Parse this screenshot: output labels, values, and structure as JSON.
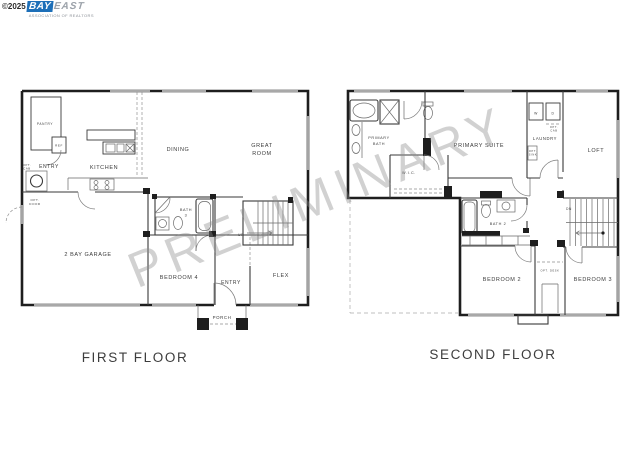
{
  "logo": {
    "copyright": "©2025",
    "brand_primary": "BAY",
    "brand_secondary": "EAST",
    "tagline": "ASSOCIATION OF REALTORS",
    "brand_color": "#1d6fb8",
    "secondary_color": "#9ba1a9"
  },
  "watermark": {
    "text": "PRELIMINARY",
    "color": "#8c8c8c"
  },
  "colors": {
    "wall_dark": "#1e1e1e",
    "wall_mid": "#3a3a3a",
    "window_light": "#bcbcbc"
  },
  "first_floor": {
    "caption": "FIRST FLOOR",
    "labels": {
      "pantry": "PANTRY",
      "ref": "REF",
      "entry_front": "ENTRY",
      "kitchen": "KITCHEN",
      "dining": "DINING",
      "great_1": "GREAT",
      "great_2": "ROOM",
      "opt_door_1": "OPT.",
      "opt_door_2": "DOOR",
      "opt_cab_1": "OPT.",
      "opt_cab_2": "CAB",
      "garage": "2 BAY GARAGE",
      "bath3_1": "BATH",
      "bath3_2": "3",
      "up": "UP",
      "bedroom4": "BEDROOM 4",
      "entry_rear": "ENTRY",
      "flex": "FLEX",
      "porch": "PORCH"
    }
  },
  "second_floor": {
    "caption": "SECOND FLOOR",
    "labels": {
      "primary_bath_1": "PRIMARY",
      "primary_bath_2": "BATH",
      "wic": "W.I.C.",
      "primary_suite": "PRIMARY SUITE",
      "laundry": "LAUNDRY",
      "washer": "W",
      "dryer": "D",
      "opt_cab_1": "OPT.",
      "opt_cab_2": "CAB",
      "opt_sink_1": "OPT.",
      "opt_sink_2": "SINK",
      "loft": "LOFT",
      "dn": "DN",
      "bath2": "BATH 2",
      "bedroom2": "BEDROOM 2",
      "bedroom3": "BEDROOM 3",
      "opt_desk": "OPT. DESK"
    }
  }
}
